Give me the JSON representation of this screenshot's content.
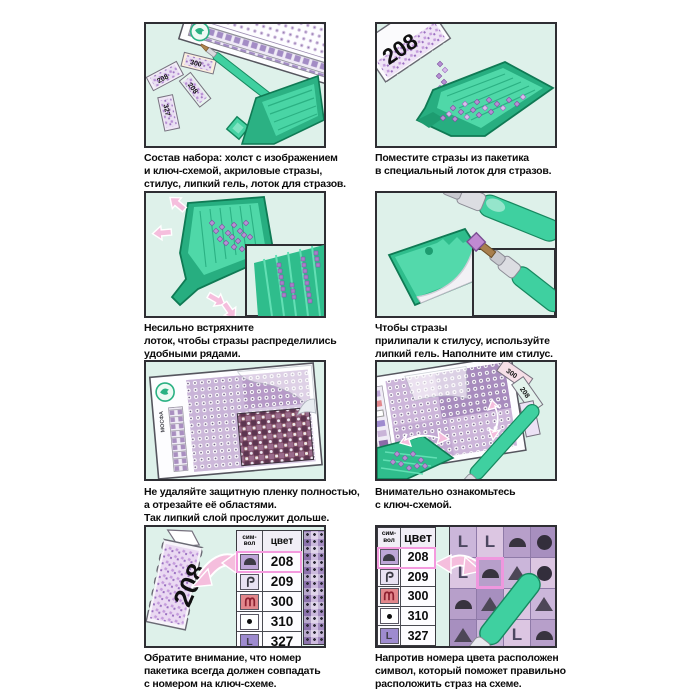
{
  "doc": {
    "kind": "diamond-painting-instruction-sheet",
    "language": "ru"
  },
  "colors": {
    "panel_bg_mint": "#def1ea",
    "tray_green": "#2bb183",
    "tray_green_light": "#49d5a5",
    "strass_purple": "#b78fd4",
    "arrow_pink": "#f5bedd",
    "highlight_pink": "#f49ade",
    "symbol_red_bg": "#e2878c",
    "symbol_red": "#8e2030"
  },
  "steps": [
    {
      "caption": "Состав набора: холст с изображением\nи ключ-схемой, акриловые стразы,\nстилус, липкий гель, лоток для стразов."
    },
    {
      "caption": "Поместите стразы из пакетика\nв специальный лоток для стразов."
    },
    {
      "caption": "Несильно встряхните\nлоток, чтобы стразы распределились\nудобными рядами."
    },
    {
      "caption": "Чтобы стразы\nприлипали к стилусу, используйте\nлипкий гель. Наполните им стилус."
    },
    {
      "caption": "Не удаляйте защитную пленку полностью,\nа отрезайте её областями.\nТак липкий слой прослужит дольше."
    },
    {
      "caption": "Внимательно ознакомьтесь\nс ключ-схемой."
    },
    {
      "caption": "Обратите внимание, что номер\nпакетика всегда должен совпадать\nс номером на ключ-схеме."
    },
    {
      "caption": "Напротив номера цвета расположен\nсимвол, который поможет правильно\nрасположить страз на схеме."
    }
  ],
  "packets": {
    "pour_label": "208",
    "key_label": "208",
    "kit_labels": [
      "208",
      "300",
      "327",
      "208"
    ],
    "scheme_labels": [
      "300",
      "208",
      "327"
    ]
  },
  "brand": {
    "name": "МОСФА"
  },
  "key_table": {
    "symbol_header": "сим-\nвол",
    "color_header": "цвет",
    "L_glyph": "L",
    "rows": [
      {
        "color": "208",
        "symbol": "dome-icon",
        "highlighted": true
      },
      {
        "color": "209",
        "symbol": "hook-icon",
        "highlighted": false
      },
      {
        "color": "300",
        "symbol": "arches-icon",
        "highlighted": false
      },
      {
        "color": "310",
        "symbol": "dot-icon",
        "highlighted": false
      },
      {
        "color": "327",
        "symbol": "letter-L-icon",
        "highlighted": false
      }
    ]
  },
  "scheme_grid": {
    "rows": [
      [
        "L",
        "L",
        "dome",
        "circle"
      ],
      [
        "L",
        "dome",
        "triangle",
        "circle"
      ],
      [
        "dome",
        "triangle",
        "circle",
        "triangle"
      ],
      [
        "triangle",
        "L",
        "L",
        "dome"
      ]
    ],
    "cell_colors": [
      [
        "a",
        "c",
        "b",
        "d"
      ],
      [
        "c",
        "b",
        "a",
        "c"
      ],
      [
        "b",
        "d",
        "c",
        "a"
      ],
      [
        "d",
        "a",
        "c",
        "b"
      ]
    ],
    "highlight_cell": [
      1,
      1
    ]
  }
}
